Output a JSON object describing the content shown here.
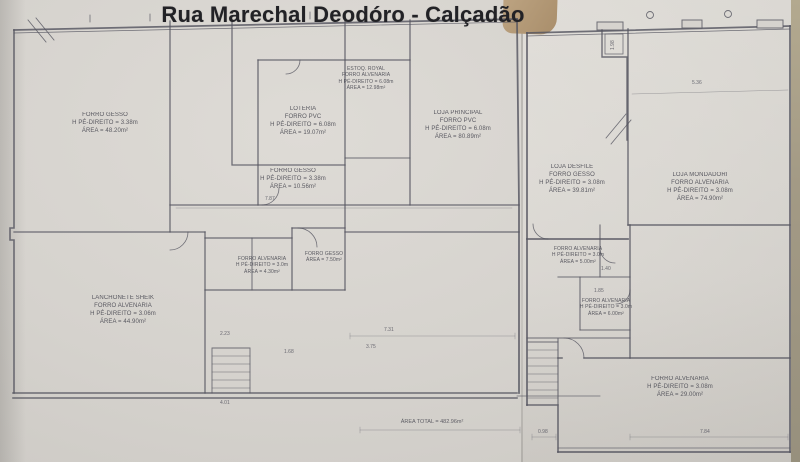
{
  "title": "Rua Marechal Deodóro - Calçadão",
  "area_total": "ÁREA TOTAL = 482.96m²",
  "rooms": [
    {
      "name": "forro-gesso-frente",
      "lines": [
        "FORRO GESSO",
        "H PÉ-DIREITO = 3.38m",
        "ÁREA = 48.20m²"
      ]
    },
    {
      "name": "loteria",
      "lines": [
        "LOTERIA",
        "FORRO PVC",
        "H PÉ-DIREITO = 6.08m",
        "ÁREA = 19.07m²"
      ]
    },
    {
      "name": "estoque-royal",
      "lines": [
        "ESTOQ. ROYAL",
        "FORRO ALVENARIA",
        "H PÉ-DIREITO = 6.08m",
        "ÁREA = 12.98m²"
      ]
    },
    {
      "name": "loja-principal",
      "lines": [
        "LOJA PRINCIPAL",
        "FORRO PVC",
        "H PÉ-DIREITO = 6.08m",
        "ÁREA = 80.89m²"
      ]
    },
    {
      "name": "forro-gesso-meio",
      "lines": [
        "FORRO GESSO",
        "H PÉ-DIREITO = 3.38m",
        "ÁREA = 10.56m²"
      ]
    },
    {
      "name": "wc-1",
      "lines": [
        "FORRO ALVENARIA",
        "H PÉ-DIREITO = 3.0m",
        "ÁREA = 4.30m²"
      ]
    },
    {
      "name": "wc-2",
      "lines": [
        "FORRO GESSO",
        "ÁREA = 7.50m²"
      ]
    },
    {
      "name": "lanchonete-sheik",
      "lines": [
        "LANCHONETE SHEIK",
        "FORRO ALVENARIA",
        "H PÉ-DIREITO = 3.06m",
        "ÁREA = 44.90m²"
      ]
    },
    {
      "name": "loja-desfile",
      "lines": [
        "LOJA DESFILE",
        "FORRO GESSO",
        "H PÉ-DIREITO = 3.08m",
        "ÁREA = 39.81m²"
      ]
    },
    {
      "name": "loja-mondadori",
      "lines": [
        "LOJA MONDADORI",
        "FORRO ALVENARIA",
        "H PÉ-DIREITO = 3.08m",
        "ÁREA = 74.90m²"
      ]
    },
    {
      "name": "deposito-1",
      "lines": [
        "FORRO ALVENARIA",
        "H PÉ-DIREITO = 3.0m",
        "ÁREA = 5.00m²"
      ]
    },
    {
      "name": "deposito-2",
      "lines": [
        "FORRO ALVENARIA",
        "H PÉ-DIREITO = 3.0m",
        "ÁREA = 6.00m²"
      ]
    },
    {
      "name": "fundos",
      "lines": [
        "FORRO ALVENARIA",
        "H PÉ-DIREITO = 3.08m",
        "ÁREA = 29.00m²"
      ]
    }
  ],
  "dims": [
    {
      "v": "7.87"
    },
    {
      "v": "5.36"
    },
    {
      "v": "1.98"
    },
    {
      "v": "2.23"
    },
    {
      "v": "1.68"
    },
    {
      "v": "7.31"
    },
    {
      "v": "3.75"
    },
    {
      "v": "4.01"
    },
    {
      "v": "1.40"
    },
    {
      "v": "1.85"
    },
    {
      "v": "0.98"
    },
    {
      "v": "7.84"
    }
  ],
  "colors": {
    "paper": "#d6d3ce",
    "line": "#565660",
    "title": "#222226",
    "table": "#ab906d"
  }
}
